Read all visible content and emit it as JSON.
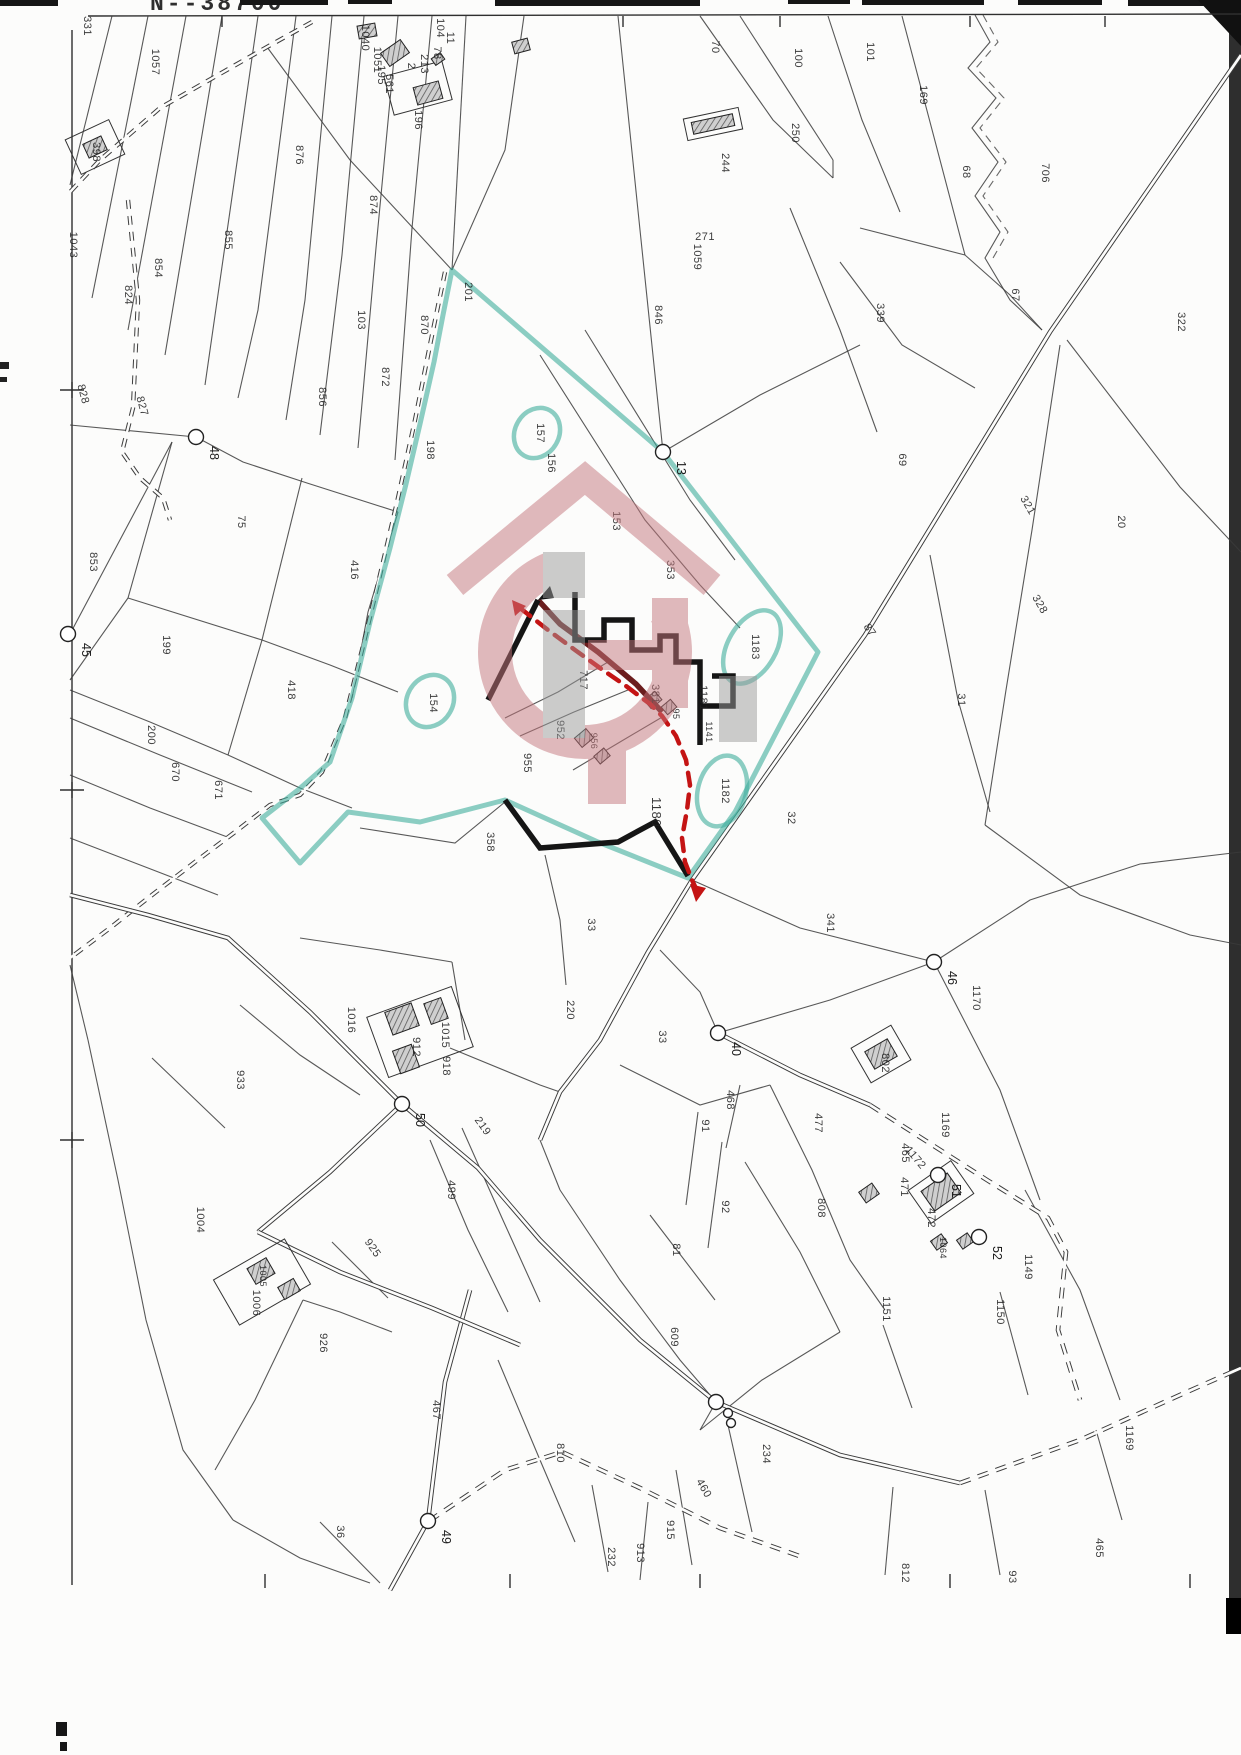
{
  "header": {
    "sheet_number": "N--38700"
  },
  "map": {
    "width": 1241,
    "height": 1755,
    "colors": {
      "teal": "#3fae9c",
      "red": "#c41414",
      "maroon": "#6b1d1d",
      "ink": "#3b3b3b",
      "watermark_pink": "#c4767c",
      "watermark_gray": "#9b9b9b"
    },
    "border": {
      "top": "88,16 1241,14",
      "left": "72,30 72,1585",
      "top_ticks": [
        222,
        623,
        780,
        970,
        1105
      ],
      "left_crosses": [
        390,
        790,
        1140
      ],
      "bottom_ticks": [
        265,
        510,
        700,
        950,
        1190
      ]
    },
    "labels": [
      [
        "331",
        84,
        26
      ],
      [
        "1057",
        152,
        62
      ],
      [
        "398",
        93,
        152
      ],
      [
        "1043",
        70,
        245
      ],
      [
        "824",
        125,
        295
      ],
      [
        "854",
        155,
        268
      ],
      [
        "855",
        225,
        240
      ],
      [
        "828",
        80,
        395,
        75
      ],
      [
        "827",
        139,
        407,
        75
      ],
      [
        "876",
        296,
        155
      ],
      [
        "874",
        370,
        205
      ],
      [
        "103",
        358,
        320
      ],
      [
        "870",
        421,
        325
      ],
      [
        "872",
        382,
        377
      ],
      [
        "856",
        319,
        397
      ],
      [
        "198",
        427,
        450
      ],
      [
        "201",
        465,
        292
      ],
      [
        "104",
        437,
        28
      ],
      [
        "196",
        415,
        120
      ],
      [
        "1040",
        362,
        38
      ],
      [
        "1051",
        374,
        60
      ],
      [
        "195",
        378,
        75
      ],
      [
        "561",
        386,
        84
      ],
      [
        "213",
        421,
        64
      ],
      [
        "78",
        434,
        53
      ],
      [
        "11",
        447,
        38
      ],
      [
        "2",
        408,
        66
      ],
      [
        "271",
        705,
        240,
        0
      ],
      [
        "1059",
        694,
        257
      ],
      [
        "70",
        712,
        47
      ],
      [
        "100",
        795,
        58
      ],
      [
        "101",
        867,
        52
      ],
      [
        "169",
        920,
        95
      ],
      [
        "250",
        792,
        133
      ],
      [
        "244",
        722,
        163
      ],
      [
        "706",
        1042,
        173
      ],
      [
        "68",
        963,
        172
      ],
      [
        "67",
        1012,
        295
      ],
      [
        "339",
        877,
        313
      ],
      [
        "322",
        1178,
        322
      ],
      [
        "846",
        655,
        315
      ],
      [
        "157",
        537,
        433
      ],
      [
        "156",
        548,
        463
      ],
      [
        "153",
        613,
        521
      ],
      [
        "353",
        667,
        570
      ],
      [
        "69",
        899,
        460
      ],
      [
        "321",
        1025,
        507,
        60
      ],
      [
        "20",
        1118,
        522
      ],
      [
        "328",
        1037,
        606,
        60
      ],
      [
        "31",
        958,
        700
      ],
      [
        "87",
        867,
        632,
        55
      ],
      [
        "75",
        238,
        522
      ],
      [
        "853",
        90,
        562
      ],
      [
        "199",
        163,
        645
      ],
      [
        "416",
        351,
        570
      ],
      [
        "418",
        288,
        690
      ],
      [
        "154",
        430,
        703
      ],
      [
        "717",
        580,
        680
      ],
      [
        "952",
        557,
        730
      ],
      [
        "955",
        524,
        763
      ],
      [
        "956",
        591,
        741,
        90,
        9
      ],
      [
        "381",
        652,
        694
      ],
      [
        "95",
        673,
        714,
        90,
        9
      ],
      [
        "1181",
        700,
        698
      ],
      [
        "1141",
        706,
        732,
        90,
        9
      ],
      [
        "1183",
        752,
        647
      ],
      [
        "1182",
        722,
        791
      ],
      [
        "1180",
        652,
        812,
        90,
        13
      ],
      [
        "32",
        788,
        818
      ],
      [
        "358",
        487,
        842
      ],
      [
        "200",
        148,
        735
      ],
      [
        "670",
        172,
        772
      ],
      [
        "671",
        215,
        790
      ],
      [
        "33",
        588,
        925
      ],
      [
        "341",
        827,
        923
      ],
      [
        "1170",
        973,
        998
      ],
      [
        "220",
        567,
        1010
      ],
      [
        "33",
        659,
        1037
      ],
      [
        "1016",
        348,
        1020
      ],
      [
        "933",
        237,
        1080
      ],
      [
        "912",
        413,
        1047
      ],
      [
        "1015",
        442,
        1035
      ],
      [
        "918",
        443,
        1066
      ],
      [
        "219",
        480,
        1128,
        55
      ],
      [
        "499",
        448,
        1190
      ],
      [
        "91",
        702,
        1126
      ],
      [
        "92",
        722,
        1207
      ],
      [
        "81",
        673,
        1250
      ],
      [
        "468",
        727,
        1100
      ],
      [
        "802",
        882,
        1063
      ],
      [
        "477",
        815,
        1123
      ],
      [
        "1169",
        942,
        1125
      ],
      [
        "465",
        902,
        1153
      ],
      [
        "1172",
        913,
        1160,
        50
      ],
      [
        "471",
        901,
        1187
      ],
      [
        "808",
        818,
        1208
      ],
      [
        "472",
        928,
        1218
      ],
      [
        "1064",
        940,
        1248,
        90,
        9
      ],
      [
        "1149",
        1025,
        1267
      ],
      [
        "1150",
        997,
        1312
      ],
      [
        "1151",
        883,
        1309
      ],
      [
        "1004",
        197,
        1220
      ],
      [
        "925",
        370,
        1250,
        55
      ],
      [
        "1005",
        260,
        1276,
        90,
        9
      ],
      [
        "1006",
        253,
        1303
      ],
      [
        "926",
        320,
        1343
      ],
      [
        "467",
        433,
        1410
      ],
      [
        "810",
        557,
        1453
      ],
      [
        "36",
        337,
        1532
      ],
      [
        "609",
        671,
        1337
      ],
      [
        "232",
        608,
        1557
      ],
      [
        "913",
        637,
        1553
      ],
      [
        "915",
        667,
        1530
      ],
      [
        "460",
        701,
        1490,
        60
      ],
      [
        "234",
        763,
        1454
      ],
      [
        "1169",
        1126,
        1438
      ],
      [
        "465",
        1096,
        1548
      ],
      [
        "93",
        1009,
        1577
      ],
      [
        "812",
        902,
        1573
      ]
    ],
    "survey_points": [
      [
        196,
        437,
        "48"
      ],
      [
        68,
        634,
        "45"
      ],
      [
        663,
        452,
        "13"
      ],
      [
        934,
        962,
        "46"
      ],
      [
        718,
        1033,
        "40"
      ],
      [
        402,
        1104,
        "50"
      ],
      [
        428,
        1521,
        "49"
      ],
      [
        938,
        1175,
        "51"
      ],
      [
        979,
        1237,
        "52"
      ],
      [
        716,
        1402,
        ""
      ],
      [
        728,
        1413,
        "",
        4.5
      ],
      [
        731,
        1423,
        "",
        4.5
      ]
    ],
    "teal": {
      "outline": "452,270 663,452 818,652 735,812 688,878 598,842 505,800 420,822 348,812 300,863 262,818 298,790 330,762 352,698 370,622 390,548 406,484 420,424 434,362 443,315 452,270",
      "circles": [
        [
          537,
          433,
          26,
          22,
          -60
        ],
        [
          430,
          701,
          27,
          23,
          -60
        ],
        [
          752,
          647,
          40,
          24,
          -60
        ],
        [
          722,
          791,
          36,
          24,
          -75
        ]
      ]
    },
    "lines": {
      "thin": [
        "112,16 70,185",
        "148,16 92,298",
        "186,16 128,330",
        "222,16 165,355",
        "258,16 205,385",
        "296,16 258,310 238,398",
        "332,16 305,300 286,420",
        "364,16 342,255 320,435",
        "398,16 376,248 358,448",
        "432,16 412,228 395,460",
        "466,16 452,270",
        "267,47 350,160 452,270",
        "524,16 505,150 452,270",
        "70,425 196,437",
        "196,437 243,462 307,483 398,512",
        "172,442 128,598 70,680",
        "128,598 262,640",
        "302,478 262,640",
        "262,640 228,755",
        "262,640 330,665 398,692",
        "228,755 300,788 352,808",
        "70,690 150,722 228,755",
        "398,512 368,612 352,698",
        "70,634 172,442",
        "70,718 160,755 252,792",
        "70,775 150,808 230,838",
        "70,838 148,868 218,895",
        "618,16 640,230 663,452",
        "740,16 833,160",
        "700,16 773,120 833,178",
        "833,160 833,178",
        "828,16 862,120 900,212",
        "902,16 930,122 965,255",
        "965,255 1010,295 1042,330",
        "860,228 965,255",
        "840,262 902,345 975,388",
        "790,208 840,330 877,432",
        "1067,340 1180,487 1241,552",
        "930,555 958,700 990,812",
        "1060,345 1032,530 1006,690 985,825",
        "985,825 1080,895 1190,935 1241,945",
        "663,452 760,395 860,345",
        "540,355 645,520 700,585",
        "585,330 690,500 735,560",
        "700,585 740,628",
        "692,880 800,928 934,962",
        "718,1033 830,1000 934,962",
        "934,962 1030,900 1140,864 1241,852",
        "934,962 1000,1090 1040,1200",
        "1025,1190 1080,1290 1120,1400",
        "660,950 700,992 718,1033",
        "620,1065 700,1105 770,1085",
        "698,1112 686,1205",
        "722,1142 708,1248",
        "650,1215 715,1300",
        "740,1085 726,1148",
        "770,1085 812,1170 850,1260 885,1310",
        "745,1162 800,1252 840,1332",
        "560,1190 620,1280 680,1360 716,1402",
        "883,1325 912,1408",
        "1000,1292 1028,1395",
        "1096,1430 1122,1520",
        "985,1490 1000,1575",
        "893,1487 885,1575",
        "88,1040 118,1180 146,1320 183,1450 233,1520",
        "303,1300 255,1400 215,1470",
        "233,1520 300,1558 370,1583",
        "320,1522 380,1583",
        "498,1360 540,1460 575,1542",
        "592,1485 608,1572",
        "648,1502 640,1580",
        "676,1470 692,1565",
        "728,1425 752,1532",
        "700,1430 762,1380 840,1332",
        "392,1332 340,1312 303,1300",
        "505,718 558,692 608,662",
        "520,736 574,712 628,690",
        "573,770 620,742 664,716",
        "540,602 580,640 618,670",
        "360,828 455,843 505,802",
        "545,855 560,920 566,985",
        "450,1048 540,1085 560,1092",
        "452,962 465,1040",
        "300,938 380,950 452,962",
        "240,1005 300,1055 360,1095",
        "152,1058 225,1128",
        "430,1140 468,1230 508,1312",
        "462,1128 502,1218 540,1302",
        "332,1242 388,1298",
        "70,965 88,1040",
        "540,1140 560,1190",
        "716,1402 700,1430"
      ],
      "zigzag": [
        "975,15 990,42 968,68 996,98 972,128 998,162 975,196 1000,232 985,258 1010,300 1042,330"
      ],
      "thin_dashed": [
        "983,15 998,42 976,68 1004,98 980,128 1006,162 983,196 1008,232 993,258"
      ]
    },
    "roads": {
      "tracks": [
        "312,22 267,47 160,108 100,160 70,192",
        "128,200 138,300 133,408 122,452 140,478 163,498 170,520",
        "445,272 430,345 415,420 398,498 380,575 362,650 345,718 322,772 300,795 270,805 235,832 195,862 152,895 110,928 70,958"
      ],
      "solid": [
        "1241,55 1050,332 865,635 692,880 648,952 600,1040 560,1092 540,1140",
        "70,895 148,915 228,938 310,1012 402,1104 478,1168 540,1240 640,1340 716,1402",
        "716,1402 840,1455 960,1483",
        "718,1033 800,1075 870,1105",
        "470,1290 445,1382 428,1521 390,1590",
        "402,1104 330,1172 258,1232",
        "258,1232 340,1272 432,1308 520,1345"
      ],
      "dashed": [
        "960,1483 1080,1440 1180,1395 1241,1368",
        "870,1105 987,1180 1048,1218 1066,1252 1058,1330 1080,1400",
        "429,1521 505,1470 562,1452 640,1488 720,1528 805,1558"
      ]
    },
    "boundary": {
      "black": [
        "488,700 538,600",
        "575,592 575,640 604,640 604,620 632,620 632,650 660,650 660,636 676,636 676,662 700,662 700,745",
        "700,706 733,706 733,676 712,676",
        "505,800 540,848 618,842 655,822 688,876"
      ],
      "flag": "538,600 550,586 554,598",
      "maroon": [
        "538,600 560,624 598,652 636,684 662,712"
      ],
      "red_dash": "520,608 548,630 575,650 600,668 626,686 650,704 662,716 676,736 686,760 690,785 687,810 682,838 685,862 692,880 698,893",
      "red_arrows": [
        "512,600 526,606 515,616",
        "690,884 706,888 696,902"
      ]
    },
    "buildings": [
      [
        428,
        93,
        26,
        18,
        -15
      ],
      [
        521,
        46,
        16,
        12,
        -15
      ],
      [
        95,
        147,
        20,
        15,
        -25
      ],
      [
        367,
        31,
        18,
        13,
        -10
      ],
      [
        395,
        53,
        24,
        16,
        -35
      ],
      [
        438,
        59,
        11,
        8,
        -35
      ],
      [
        713,
        124,
        42,
        12,
        -12
      ],
      [
        584,
        738,
        15,
        12,
        -40
      ],
      [
        602,
        756,
        13,
        10,
        -40
      ],
      [
        653,
        700,
        14,
        11,
        -40
      ],
      [
        669,
        707,
        12,
        10,
        -40
      ],
      [
        402,
        1019,
        28,
        24,
        -20
      ],
      [
        436,
        1011,
        18,
        22,
        -20
      ],
      [
        406,
        1059,
        20,
        24,
        -20
      ],
      [
        881,
        1054,
        26,
        20,
        -30
      ],
      [
        869,
        1193,
        16,
        13,
        -35
      ],
      [
        941,
        1192,
        32,
        24,
        -35
      ],
      [
        939,
        1242,
        13,
        11,
        -35
      ],
      [
        965,
        1241,
        13,
        11,
        -35
      ],
      [
        261,
        1271,
        22,
        18,
        -30
      ],
      [
        289,
        1289,
        18,
        14,
        -30
      ]
    ],
    "outlines": [
      [
        95,
        147,
        48,
        38,
        -25
      ],
      [
        418,
        88,
        60,
        40,
        -15
      ],
      [
        713,
        124,
        56,
        22,
        -12
      ],
      [
        881,
        1054,
        46,
        40,
        -30
      ],
      [
        262,
        1282,
        82,
        52,
        -30
      ],
      [
        420,
        1032,
        90,
        64,
        -20
      ],
      [
        941,
        1192,
        52,
        40,
        -35
      ]
    ],
    "watermark": {
      "opacity": 0.5,
      "roof": "455,585 585,478 712,585",
      "ring": {
        "cx": 585,
        "cy": 652,
        "r": 90,
        "width": 34,
        "dash": "430 136",
        "rot": -25
      },
      "gbar": [
        588,
        640,
        80,
        30
      ],
      "gstem": [
        652,
        598,
        36,
        110
      ],
      "tail": [
        588,
        744,
        38,
        60
      ],
      "idot": [
        543,
        552,
        42,
        46
      ],
      "ibar": [
        543,
        610,
        42,
        128
      ],
      "grayblock": [
        719,
        676,
        38,
        66
      ]
    },
    "artifacts": {
      "top_bars": [
        [
          0,
          0,
          58,
          6
        ],
        [
          240,
          0,
          88,
          5
        ],
        [
          348,
          0,
          44,
          4
        ],
        [
          495,
          0,
          205,
          6
        ],
        [
          788,
          0,
          62,
          4
        ],
        [
          862,
          0,
          122,
          5
        ],
        [
          1018,
          0,
          84,
          5
        ],
        [
          1128,
          0,
          113,
          6
        ]
      ],
      "left_marks": [
        [
          0,
          362,
          9,
          7
        ],
        [
          0,
          377,
          7,
          5
        ]
      ],
      "bottom_marks": [
        [
          56,
          1722,
          11,
          14
        ],
        [
          60,
          1742,
          7,
          9
        ]
      ],
      "right_band": [
        1229,
        0,
        12,
        1632
      ],
      "right_corner": "1198,0 1241,0 1241,46",
      "right_blob": [
        1226,
        1598,
        15,
        36
      ]
    }
  }
}
